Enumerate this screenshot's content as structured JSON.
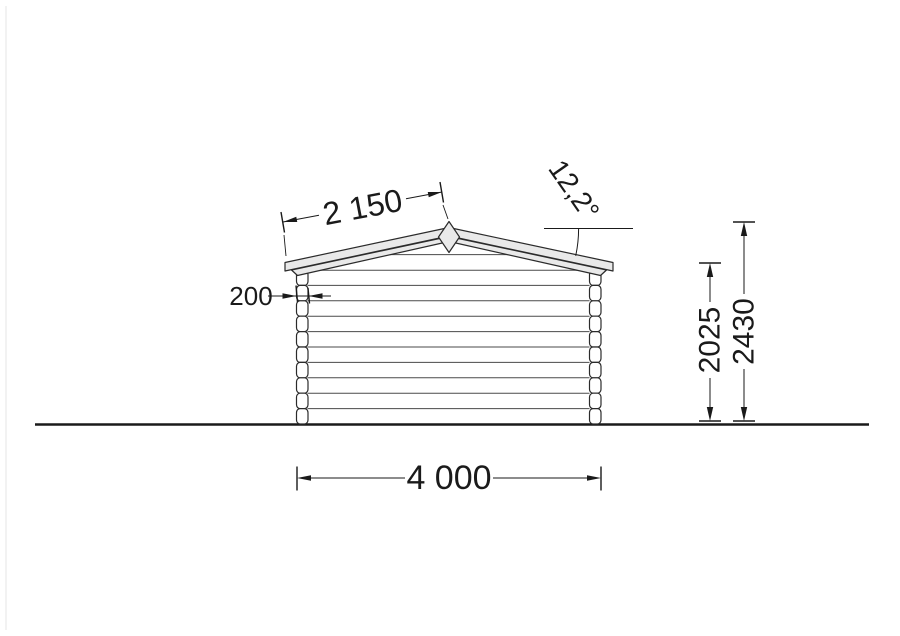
{
  "drawing": {
    "dimensions": {
      "roof_slope_length": "2 150",
      "roof_angle": "12,2°",
      "wall_thickness": "200",
      "eaves_height": "2025",
      "ridge_height": "2430",
      "total_width": "4 000"
    },
    "colors": {
      "background": "#ffffff",
      "structure_line": "#2b2b2b",
      "dimension_line": "#1a1a1a",
      "fascia_fill": "#e9e9e9"
    }
  }
}
